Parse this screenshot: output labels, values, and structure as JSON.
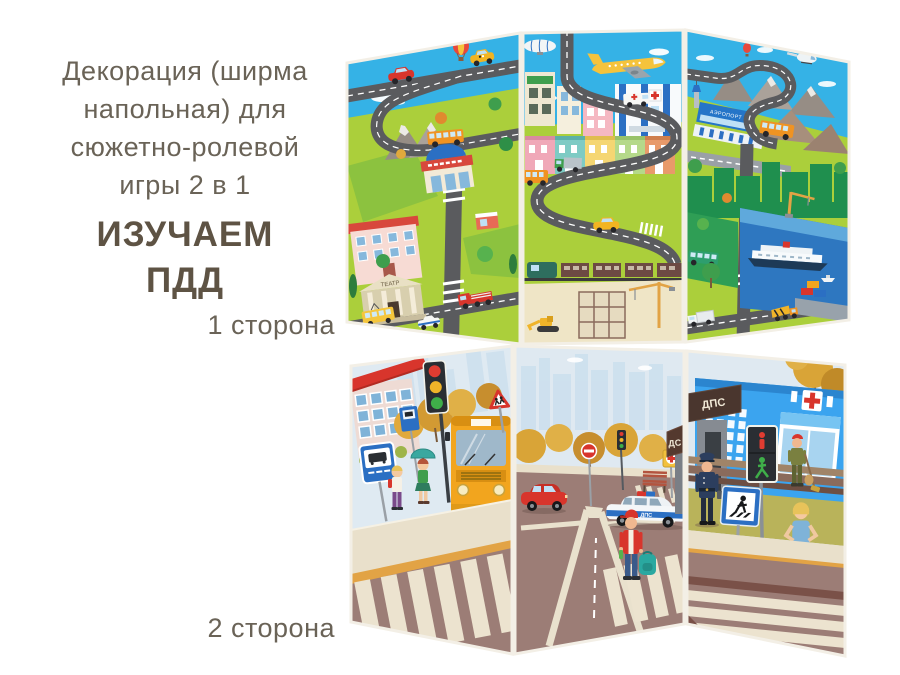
{
  "product_caption": {
    "lines": [
      "Декорация (ширма",
      "напольная) для",
      "сюжетно-ролевой",
      "игры 2 в 1"
    ],
    "highlight_lines": [
      "ИЗУЧАЕМ",
      "ПДД"
    ]
  },
  "side_labels": {
    "side1": "1 сторона",
    "side2": "2 сторона"
  },
  "screen_side1": {
    "texts": {
      "theater_sign": "ТЕАТР",
      "airport_sign": "АЭРОПОРТ"
    }
  },
  "screen_side2": {
    "texts": {
      "dps_sign_left": "ДС",
      "dps_sign": "ДПС",
      "police_car_marking": "ДПС"
    }
  },
  "colors": {
    "caption_text": "#6a6357",
    "caption_strong": "#5e5344",
    "sky": "#35b2e6",
    "grass": "#abcf3b",
    "map_road": "#5a5b5e",
    "street_road": "#9c7d76",
    "sidewalk": "#e9e0cb",
    "curb_orange": "#e2a345",
    "autumn_tree": "#d9a437",
    "hospital_blue": "#3ba4ef",
    "accent_red": "#d8352c",
    "bus_yellow": "#f2a51e",
    "sign_blue": "#2b6fc3",
    "dps_brown": "#4a362e",
    "water_blue": "#2e77c0",
    "pale_sky": "#dfe9f1"
  }
}
